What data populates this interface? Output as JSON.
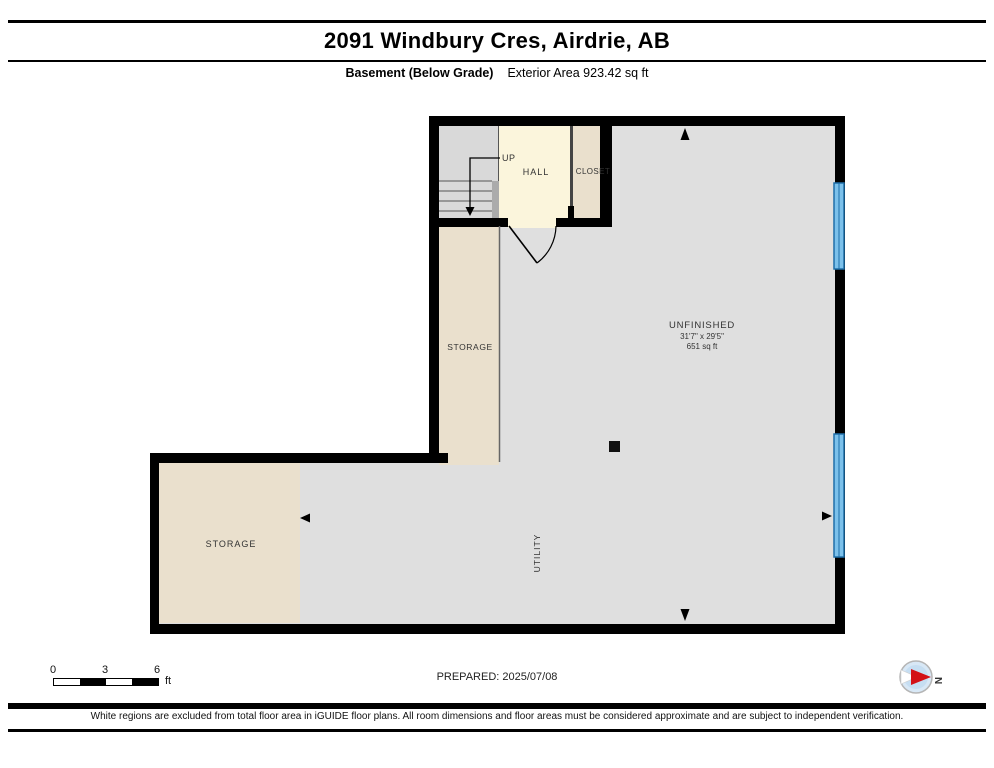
{
  "header": {
    "title": "2091 Windbury Cres, Airdrie, AB",
    "floor_label": "Basement (Below Grade)",
    "area_label": "Exterior Area 923.42 sq ft"
  },
  "plan": {
    "up_label": "UP",
    "hall_label": "HALL",
    "closet_label": "CLOSET",
    "storage_upper_label": "STORAGE",
    "storage_lower_label": "STORAGE",
    "utility_label": "UTILITY",
    "unfinished": {
      "name": "UNFINISHED",
      "dimensions": "31'7\" x 29'5\"",
      "area": "651 sq ft"
    }
  },
  "scale_bar": {
    "ticks": [
      "0",
      "3",
      "6"
    ],
    "unit": "ft"
  },
  "footer": {
    "prepared_label": "PREPARED: 2025/07/08",
    "disclaimer": "White regions are excluded from total floor area in iGUIDE floor plans. All room dimensions and floor areas must be considered approximate and are subject to independent verification.",
    "compass_label": "N"
  },
  "colors": {
    "wall": "#000000",
    "floor_gray": "#DFDFDF",
    "floor_beige": "#EAE0CD",
    "floor_cream": "#FBF5DC",
    "window_fill": "#7CC1EB",
    "window_stroke": "#1E6FA9",
    "compass_red": "#D31117"
  }
}
